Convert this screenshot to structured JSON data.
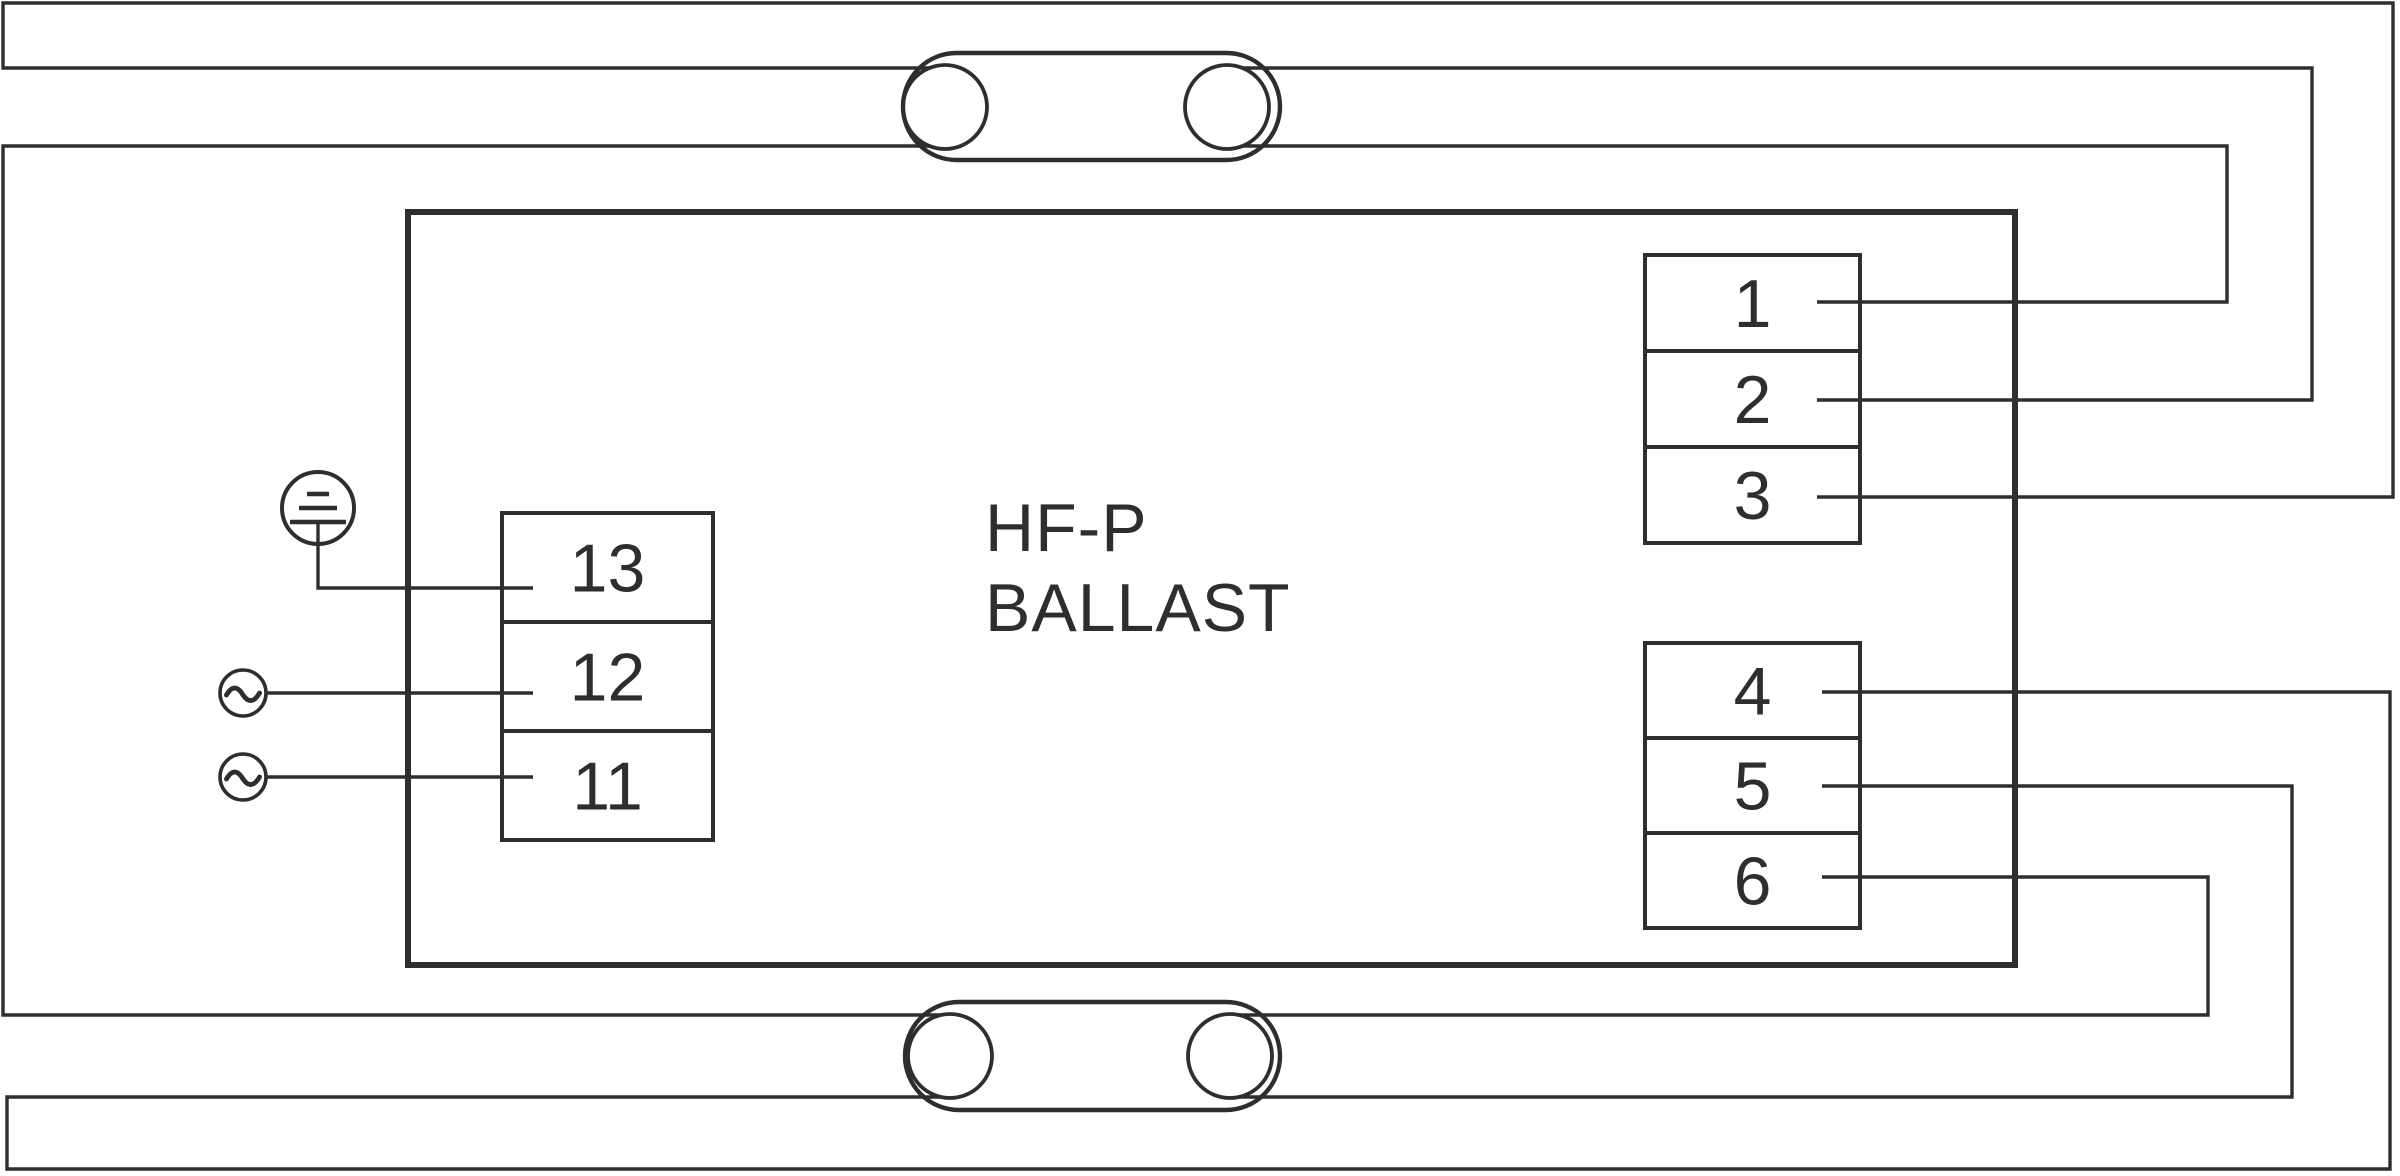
{
  "canvas": {
    "width": 2400,
    "height": 1176
  },
  "colors": {
    "line": "#2e2e2e",
    "background": "#ffffff"
  },
  "ballast": {
    "label_line1": "HF-P",
    "label_line2": "BALLAST",
    "box": {
      "x": 408,
      "y": 212,
      "w": 1607,
      "h": 753,
      "stroke_w": 6
    }
  },
  "terminal_font_size": 68,
  "terminal_blocks": [
    {
      "name": "terminal-block-1-3",
      "x": 1645,
      "y": 255,
      "w": 215,
      "row_h": 96,
      "stroke_w": 4,
      "labels": [
        "1",
        "2",
        "3"
      ]
    },
    {
      "name": "terminal-block-4-6",
      "x": 1645,
      "y": 643,
      "w": 215,
      "row_h": 95,
      "stroke_w": 4,
      "labels": [
        "4",
        "5",
        "6"
      ]
    },
    {
      "name": "terminal-block-11-13",
      "x": 502,
      "y": 513,
      "w": 211,
      "row_h": 109,
      "stroke_w": 4,
      "labels": [
        "13",
        "12",
        "11"
      ]
    }
  ],
  "lamps": [
    {
      "name": "fluorescent-lamp-top",
      "x": 903,
      "y": 53,
      "w": 377,
      "h": 107,
      "stroke_w": 4.4,
      "filaments": [
        {
          "cx": 945,
          "cy": 107,
          "r": 42
        },
        {
          "cx": 1227,
          "cy": 107,
          "r": 42
        }
      ],
      "filament_stroke_w": 3.8
    },
    {
      "name": "fluorescent-lamp-bottom",
      "x": 905,
      "y": 1002,
      "w": 375,
      "h": 108,
      "stroke_w": 4.4,
      "filaments": [
        {
          "cx": 950,
          "cy": 1056,
          "r": 42
        },
        {
          "cx": 1230,
          "cy": 1056,
          "r": 42
        }
      ],
      "filament_stroke_w": 3.8
    }
  ],
  "wires": [
    {
      "name": "wire-terminal3-to-lamp1-left-upper-pin",
      "stroke_w": 3.4,
      "points": [
        [
          1817,
          497
        ],
        [
          2393,
          497
        ],
        [
          2393,
          3
        ],
        [
          3,
          3
        ],
        [
          3,
          68
        ],
        [
          929,
          68
        ]
      ]
    },
    {
      "name": "wire-lamp1-left-lower-pin-to-lamp2-left-upper-pin",
      "stroke_w": 3.4,
      "points": [
        [
          929,
          146
        ],
        [
          3,
          146
        ],
        [
          3,
          1015
        ],
        [
          941,
          1015
        ]
      ]
    },
    {
      "name": "wire-terminal2-to-lamp1-right-upper-pin",
      "stroke_w": 3.4,
      "points": [
        [
          1817,
          400
        ],
        [
          2312,
          400
        ],
        [
          2312,
          68
        ],
        [
          1243,
          68
        ]
      ]
    },
    {
      "name": "wire-terminal1-to-lamp1-right-lower-pin",
      "stroke_w": 3.4,
      "points": [
        [
          1817,
          302
        ],
        [
          2227,
          302
        ],
        [
          2227,
          146
        ],
        [
          1243,
          146
        ]
      ]
    },
    {
      "name": "wire-terminal4-to-lamp2-left-lower-pin",
      "stroke_w": 3.4,
      "points": [
        [
          1822,
          692
        ],
        [
          2390,
          692
        ],
        [
          2390,
          1169
        ],
        [
          7,
          1169
        ],
        [
          7,
          1097
        ],
        [
          941,
          1097
        ]
      ]
    },
    {
      "name": "wire-terminal5-to-lamp2-right-lower-pin",
      "stroke_w": 3.4,
      "points": [
        [
          1822,
          786
        ],
        [
          2292,
          786
        ],
        [
          2292,
          1097
        ],
        [
          1239,
          1097
        ]
      ]
    },
    {
      "name": "wire-terminal6-to-lamp2-right-upper-pin",
      "stroke_w": 3.4,
      "points": [
        [
          1822,
          877
        ],
        [
          2208,
          877
        ],
        [
          2208,
          1015
        ],
        [
          1239,
          1015
        ]
      ]
    },
    {
      "name": "wire-earth-to-terminal13",
      "stroke_w": 3.4,
      "points": [
        [
          318,
          522
        ],
        [
          318,
          588
        ],
        [
          533,
          588
        ]
      ]
    },
    {
      "name": "wire-ac-line-to-terminal12",
      "stroke_w": 3.4,
      "points": [
        [
          266,
          693
        ],
        [
          533,
          693
        ]
      ]
    },
    {
      "name": "wire-ac-neutral-to-terminal11",
      "stroke_w": 3.4,
      "points": [
        [
          266,
          777
        ],
        [
          533,
          777
        ]
      ]
    }
  ],
  "earth_symbol": {
    "name": "earth-ground-icon",
    "cx": 318,
    "cy": 508,
    "r": 36,
    "stroke_w": 4,
    "bars": [
      {
        "y": 494,
        "half_w": 11,
        "stroke_w": 4.5
      },
      {
        "y": 508,
        "half_w": 19,
        "stroke_w": 4.5
      },
      {
        "y": 522,
        "half_w": 28,
        "stroke_w": 4.5
      }
    ]
  },
  "ac_sources": [
    {
      "name": "ac-source-live-icon",
      "cx": 243,
      "cy": 693,
      "r": 23,
      "stroke_w": 3.6
    },
    {
      "name": "ac-source-neutral-icon",
      "cx": 243,
      "cy": 777,
      "r": 23,
      "stroke_w": 3.6
    }
  ]
}
